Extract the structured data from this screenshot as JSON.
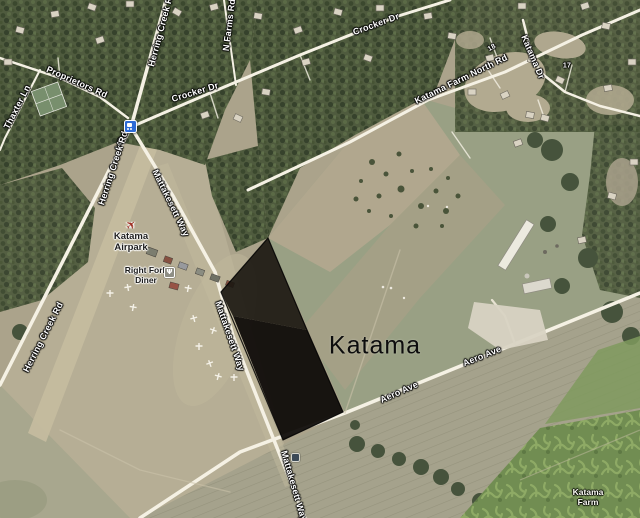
{
  "map": {
    "locality_label": "Katama",
    "road_labels": {
      "herring_creek_rd_top": "Herring Creek Rd",
      "herring_creek_rd_mid": "Herring Creek Rd",
      "herring_creek_rd_south": "Herring Creek Rd",
      "route_140": "140",
      "thaxter_ln": "Thaxter Ln",
      "proprietors_rd": "Proprietors Rd",
      "crocker_dr_west": "Crocker Dr",
      "crocker_dr_east": "Crocker Dr",
      "n_farms_rd": "N Farms Rd",
      "katama_farm_north_rd": "Katama Farm North Rd",
      "katama_dr": "Katama Dr",
      "mattakesett_way_north": "Mattakesett Way",
      "mattakesett_way_mid": "Mattakesett Way",
      "mattakesett_way_south": "Mattakesett Way",
      "aero_ave_west": "Aero Ave",
      "aero_ave_east": "Aero Ave",
      "marker_18": "18",
      "marker_17": "17"
    },
    "poi_labels": {
      "airpark_line1": "Katama",
      "airpark_line2": "Airpark",
      "diner_line1": "Right Fork",
      "diner_line2": "Diner",
      "farm_line1": "Katama",
      "farm_line2": "Farm"
    },
    "icons": {
      "transit_stop": "bus-icon",
      "airpark": "airplane-icon",
      "diner": "restaurant-icon",
      "south_stop": "bus-icon",
      "diner_glyph": "Ψ"
    },
    "colors": {
      "selection_overlay": "#14100d",
      "road": "#f5f1e3",
      "forest": "#4e5b3c",
      "field_tan": "#b3aa90",
      "field_green": "#99a082",
      "maze_green": "#6f8e4e",
      "transit_blue": "#2e6bd6",
      "airplane_red": "#9e2f23"
    }
  }
}
